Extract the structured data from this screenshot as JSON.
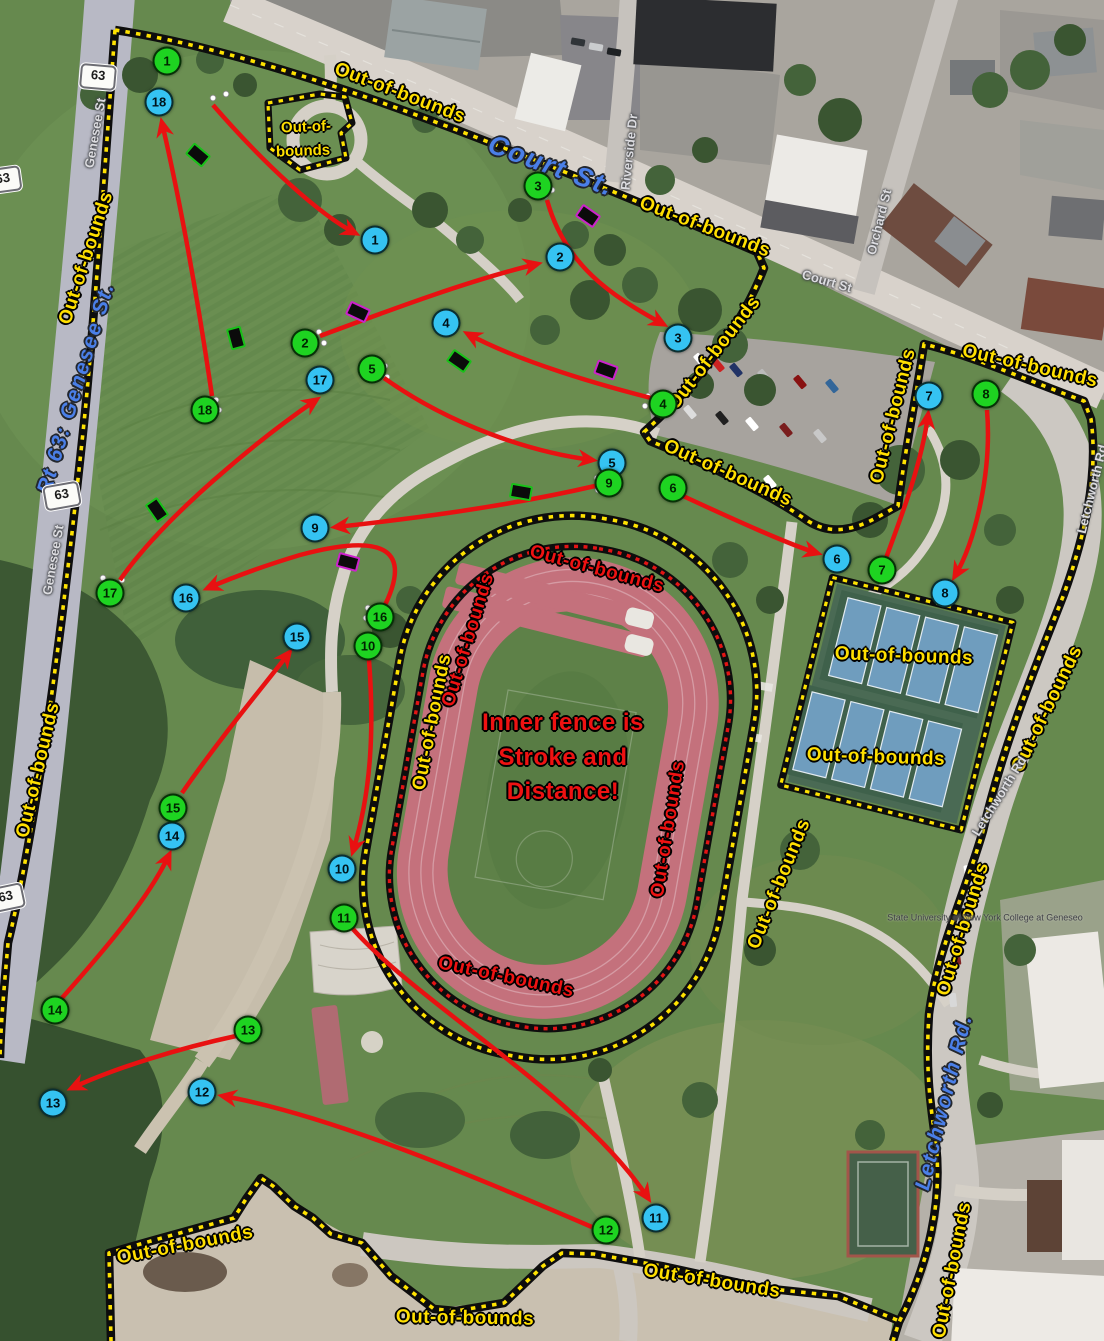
{
  "map": {
    "description_colors": {
      "tee_circle": "#35c3f2",
      "basket_circle": "#1ed321",
      "arrow_red": "#e81111",
      "boundary_yellow": "#ffe200",
      "boundary_red": "#e31414",
      "oob_text_yellow": "#ffdf00",
      "oob_text_red": "#ee1212",
      "street_text_blue": "#4a7fe8"
    },
    "text_labels": [
      {
        "name": "oob-top-court",
        "text": "Out-of-bounds",
        "x": 400,
        "y": 93,
        "rot": 21,
        "cls": "oob-y"
      },
      {
        "name": "oob-genesee-upper",
        "text": "Out-of-bounds",
        "x": 86,
        "y": 258,
        "rot": -72,
        "cls": "oob-y"
      },
      {
        "name": "oob-genesee-lower",
        "text": "Out-of-bounds",
        "x": 38,
        "y": 770,
        "rot": -77,
        "cls": "oob-y"
      },
      {
        "name": "oob-court-south",
        "text": "Out-of-bounds",
        "x": 705,
        "y": 227,
        "rot": 21,
        "cls": "oob-y"
      },
      {
        "name": "oob-island-line-1",
        "text": "Out-of-",
        "x": 306,
        "y": 127,
        "rot": -2,
        "cls": "island"
      },
      {
        "name": "oob-island-line-2",
        "text": "bounds",
        "x": 303,
        "y": 151,
        "rot": -2,
        "cls": "island"
      },
      {
        "name": "oob-parking-west",
        "text": "Out-of-bounds",
        "x": 714,
        "y": 353,
        "rot": -52,
        "cls": "oob-y"
      },
      {
        "name": "oob-parking-south",
        "text": "Out-of-bounds",
        "x": 728,
        "y": 473,
        "rot": 24,
        "cls": "oob-y"
      },
      {
        "name": "oob-parking-east",
        "text": "Out-of-bounds",
        "x": 893,
        "y": 416,
        "rot": -76,
        "cls": "oob-y"
      },
      {
        "name": "oob-northeast",
        "text": "Out-of-bounds",
        "x": 1030,
        "y": 366,
        "rot": 13,
        "cls": "oob-y"
      },
      {
        "name": "oob-letchworth-upper",
        "text": "Out-of-bounds",
        "x": 1047,
        "y": 709,
        "rot": -64,
        "cls": "oob-y"
      },
      {
        "name": "oob-letchworth-mid",
        "text": "Out-of-bounds",
        "x": 963,
        "y": 929,
        "rot": -73,
        "cls": "oob-y"
      },
      {
        "name": "oob-letchworth-lower",
        "text": "Out-of-bounds",
        "x": 952,
        "y": 1270,
        "rot": -79,
        "cls": "oob-y"
      },
      {
        "name": "oob-tennis-upper",
        "text": "Out-of-bounds",
        "x": 904,
        "y": 656,
        "rot": 2,
        "cls": "oob-y"
      },
      {
        "name": "oob-tennis-lower",
        "text": "Out-of-bounds",
        "x": 876,
        "y": 757,
        "rot": 2,
        "cls": "oob-y"
      },
      {
        "name": "oob-bottom-left",
        "text": "Out-of-bounds",
        "x": 185,
        "y": 1245,
        "rot": -11,
        "cls": "oob-y"
      },
      {
        "name": "oob-bottom-center",
        "text": "Out-of-bounds",
        "x": 465,
        "y": 1318,
        "rot": 1,
        "cls": "oob-y"
      },
      {
        "name": "oob-bottom-road",
        "text": "Out-of-bounds",
        "x": 712,
        "y": 1281,
        "rot": 9,
        "cls": "oob-y"
      },
      {
        "name": "oob-track-outer-west",
        "text": "Out-of-bounds",
        "x": 432,
        "y": 722,
        "rot": -79,
        "cls": "oob-y"
      },
      {
        "name": "oob-track-outer-southeast",
        "text": "Out-of-bounds",
        "x": 779,
        "y": 884,
        "rot": -68,
        "cls": "oob-y"
      },
      {
        "name": "oob-track-north",
        "text": "Out-of-bounds",
        "x": 597,
        "y": 569,
        "rot": 15,
        "cls": "oob-r"
      },
      {
        "name": "oob-track-west-inner",
        "text": "Out-of-bounds",
        "x": 468,
        "y": 640,
        "rot": -73,
        "cls": "oob-r"
      },
      {
        "name": "oob-track-east-inner",
        "text": "Out-of-bounds",
        "x": 668,
        "y": 829,
        "rot": -81,
        "cls": "oob-r"
      },
      {
        "name": "oob-track-south-inner",
        "text": "Out-of-bounds",
        "x": 506,
        "y": 977,
        "rot": 12,
        "cls": "oob-r"
      },
      {
        "name": "track-note-line-1",
        "text": "Inner fence is",
        "x": 563,
        "y": 723,
        "rot": 0,
        "cls": "note-red"
      },
      {
        "name": "track-note-line-2",
        "text": "Stroke and",
        "x": 563,
        "y": 758,
        "rot": 0,
        "cls": "note-red"
      },
      {
        "name": "track-note-line-3",
        "text": "Distance!",
        "x": 563,
        "y": 792,
        "rot": 0,
        "cls": "note-red"
      },
      {
        "name": "street-court-st-main",
        "text": "Court St.",
        "x": 551,
        "y": 166,
        "rot": 20,
        "cls": "street-blue",
        "size": 27
      },
      {
        "name": "street-rt63-genesee",
        "text": "Rt 63: Genesee St.",
        "x": 76,
        "y": 388,
        "rot": -73,
        "cls": "street-blue"
      },
      {
        "name": "street-letchworth-main",
        "text": "Letchworth Rd.",
        "x": 944,
        "y": 1102,
        "rot": -76,
        "cls": "street-blue"
      },
      {
        "name": "street-genesee-top",
        "text": "Genesee St",
        "x": 95,
        "y": 133,
        "rot": -80,
        "cls": "street-gray"
      },
      {
        "name": "street-genesee-mid",
        "text": "Genesee St",
        "x": 53,
        "y": 560,
        "rot": -80,
        "cls": "street-gray"
      },
      {
        "name": "street-riverside-dr",
        "text": "Riverside Dr",
        "x": 629,
        "y": 152,
        "rot": -84,
        "cls": "street-gray"
      },
      {
        "name": "street-court-small",
        "text": "Court St",
        "x": 827,
        "y": 281,
        "rot": 16,
        "cls": "street-gray"
      },
      {
        "name": "street-orchard-st",
        "text": "Orchard St",
        "x": 879,
        "y": 222,
        "rot": -76,
        "cls": "street-gray"
      },
      {
        "name": "street-letchworth-small-1",
        "text": "Letchworth Rd",
        "x": 1092,
        "y": 489,
        "rot": -76,
        "cls": "street-gray"
      },
      {
        "name": "street-letchworth-small-2",
        "text": "Letchworth Rd",
        "x": 999,
        "y": 796,
        "rot": -58,
        "cls": "street-gray"
      },
      {
        "name": "college-label",
        "text": "State University of New York College at Geneseo",
        "x": 985,
        "y": 918,
        "rot": 0,
        "cls": "college"
      }
    ],
    "route_shields": [
      {
        "text": "63",
        "x": 98,
        "y": 77,
        "rot": 5
      },
      {
        "text": "63",
        "x": 3,
        "y": 180,
        "rot": -8
      },
      {
        "text": "63",
        "x": 62,
        "y": 496,
        "rot": -10
      },
      {
        "text": "63",
        "x": 6,
        "y": 898,
        "rot": -12
      }
    ],
    "markers": {
      "tees": [
        {
          "n": "1",
          "x": 375,
          "y": 240
        },
        {
          "n": "2",
          "x": 560,
          "y": 257
        },
        {
          "n": "3",
          "x": 678,
          "y": 338
        },
        {
          "n": "4",
          "x": 446,
          "y": 323
        },
        {
          "n": "5",
          "x": 612,
          "y": 463
        },
        {
          "n": "6",
          "x": 837,
          "y": 559
        },
        {
          "n": "7",
          "x": 929,
          "y": 396
        },
        {
          "n": "8",
          "x": 945,
          "y": 593
        },
        {
          "n": "9",
          "x": 315,
          "y": 528
        },
        {
          "n": "10",
          "x": 342,
          "y": 869
        },
        {
          "n": "11",
          "x": 656,
          "y": 1218
        },
        {
          "n": "12",
          "x": 202,
          "y": 1092
        },
        {
          "n": "13",
          "x": 53,
          "y": 1103
        },
        {
          "n": "14",
          "x": 172,
          "y": 836
        },
        {
          "n": "15",
          "x": 297,
          "y": 637
        },
        {
          "n": "16",
          "x": 186,
          "y": 598
        },
        {
          "n": "17",
          "x": 320,
          "y": 380
        },
        {
          "n": "18",
          "x": 159,
          "y": 102
        }
      ],
      "baskets": [
        {
          "n": "1",
          "x": 167,
          "y": 61
        },
        {
          "n": "2",
          "x": 305,
          "y": 343
        },
        {
          "n": "3",
          "x": 538,
          "y": 186
        },
        {
          "n": "4",
          "x": 663,
          "y": 404
        },
        {
          "n": "5",
          "x": 372,
          "y": 369
        },
        {
          "n": "6",
          "x": 673,
          "y": 488
        },
        {
          "n": "7",
          "x": 882,
          "y": 570
        },
        {
          "n": "8",
          "x": 986,
          "y": 394
        },
        {
          "n": "9",
          "x": 609,
          "y": 483
        },
        {
          "n": "10",
          "x": 368,
          "y": 646
        },
        {
          "n": "11",
          "x": 344,
          "y": 918
        },
        {
          "n": "12",
          "x": 606,
          "y": 1230
        },
        {
          "n": "13",
          "x": 248,
          "y": 1030
        },
        {
          "n": "14",
          "x": 55,
          "y": 1010
        },
        {
          "n": "15",
          "x": 173,
          "y": 808
        },
        {
          "n": "16",
          "x": 380,
          "y": 617
        },
        {
          "n": "17",
          "x": 110,
          "y": 593
        },
        {
          "n": "18",
          "x": 205,
          "y": 410
        }
      ]
    },
    "tee_pads": [
      {
        "x": 198,
        "y": 155,
        "rot": 40,
        "c": "#19c119"
      },
      {
        "x": 588,
        "y": 216,
        "rot": 35,
        "c": "#cc22cc"
      },
      {
        "x": 358,
        "y": 312,
        "rot": 25,
        "c": "#cc22cc"
      },
      {
        "x": 236,
        "y": 338,
        "rot": 75,
        "c": "#19c119"
      },
      {
        "x": 459,
        "y": 361,
        "rot": 35,
        "c": "#19c119"
      },
      {
        "x": 606,
        "y": 370,
        "rot": 20,
        "c": "#cc22cc"
      },
      {
        "x": 521,
        "y": 492,
        "rot": 10,
        "c": "#19c119"
      },
      {
        "x": 157,
        "y": 510,
        "rot": 55,
        "c": "#19c119"
      },
      {
        "x": 348,
        "y": 562,
        "rot": 15,
        "c": "#cc22cc"
      }
    ]
  }
}
